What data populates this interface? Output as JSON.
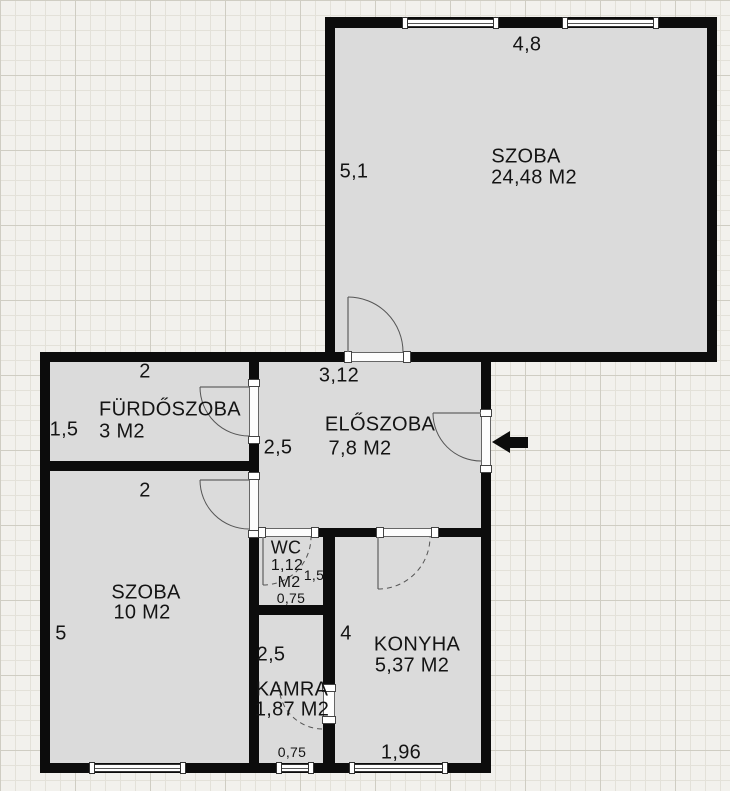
{
  "rooms": {
    "szoba_nagy": {
      "name": "SZOBA",
      "area": "24,48 M2",
      "dim_width": "4,8",
      "dim_height": "5,1"
    },
    "furdoszoba": {
      "name": "FÜRDŐSZOBA",
      "area": "3 M2",
      "dim_width": "2",
      "dim_height": "1,5"
    },
    "eloszoba": {
      "name": "ELŐSZOBA",
      "area": "7,8 M2",
      "dim_width": "3,12",
      "dim_height": "2,5"
    },
    "szoba_kis": {
      "name": "SZOBA",
      "area": "10 M2",
      "dim_width": "2",
      "dim_height": "5"
    },
    "wc": {
      "name": "WC",
      "area_value": "1,12",
      "area_unit": "M2",
      "dim_height": "1,5",
      "dim_width": "0,75"
    },
    "kamra": {
      "name": "KAMRA",
      "area": "1,87 M2",
      "dim_height": "2,5",
      "dim_width": "0,75"
    },
    "konyha": {
      "name": "KONYHA",
      "area": "5,37 M2",
      "dim_height": "4",
      "dim_width": "1,96"
    }
  },
  "colors": {
    "wall": "#0c0c0c",
    "room_fill": "#dbdbdb",
    "background": "#f2f1ed",
    "grid_minor": "#e3e1d9",
    "grid_major": "#cfcdc3",
    "text": "#141414",
    "door_line": "#555555",
    "window_frame": "#333333",
    "arrow": "#0c0c0c"
  }
}
